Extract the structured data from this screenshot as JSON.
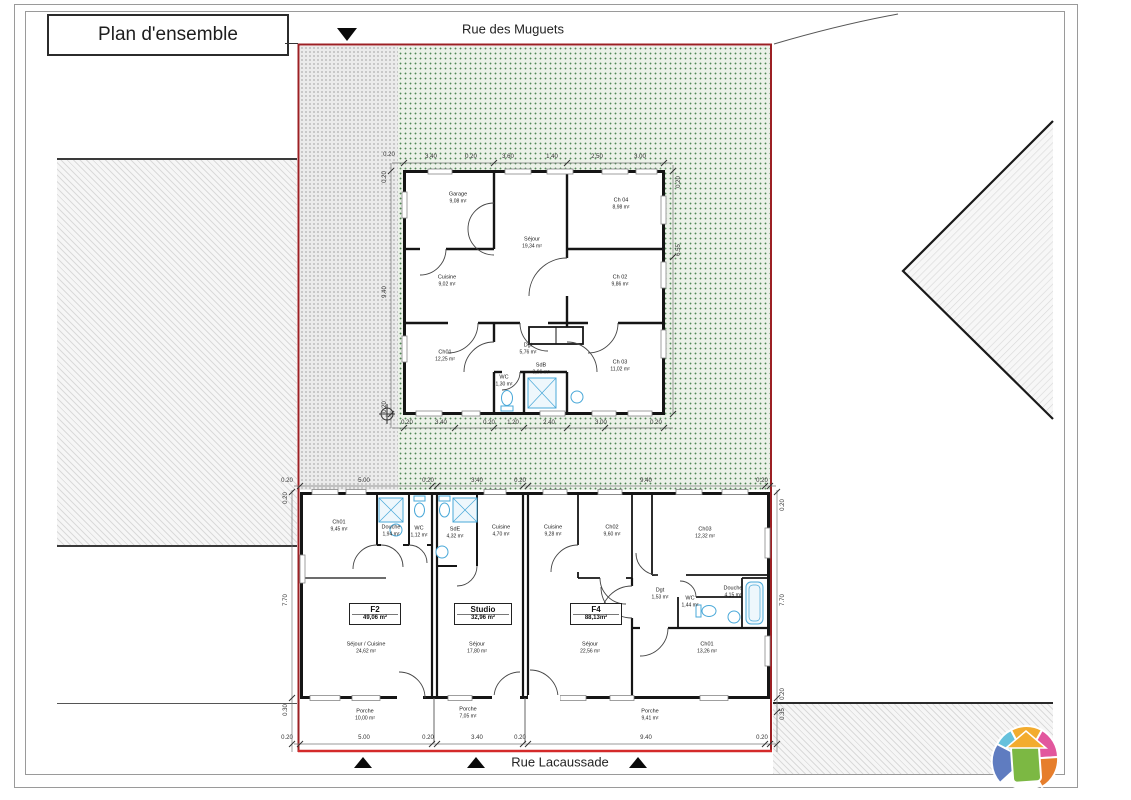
{
  "title": "Plan d'ensemble",
  "streets": {
    "top": "Rue des Muguets",
    "bottom": "Rue Lacaussade"
  },
  "house": {
    "rooms": [
      {
        "name": "Garage",
        "area": "9,08 m²"
      },
      {
        "name": "Cuisine",
        "area": "9,02 m²"
      },
      {
        "name": "Séjour",
        "area": "19,34 m²"
      },
      {
        "name": "Ch 04",
        "area": "8,98 m²"
      },
      {
        "name": "Ch 02",
        "area": "9,86 m²"
      },
      {
        "name": "Ch01",
        "area": "12,25 m²"
      },
      {
        "name": "Dgt",
        "area": "5,76 m²"
      },
      {
        "name": "Ch 03",
        "area": "11,02 m²"
      },
      {
        "name": "WC",
        "area": "1,30 m²"
      },
      {
        "name": "SdB",
        "area": "3,96 m²"
      }
    ]
  },
  "units": {
    "f2": {
      "label": "F2",
      "area": "49,06 m²",
      "rooms": [
        {
          "name": "Ch01",
          "area": "9,45 m²"
        },
        {
          "name": "Douche",
          "area": "1,94 m²"
        },
        {
          "name": "WC",
          "area": "1,12 m²"
        },
        {
          "name": "Séjour / Cuisine",
          "area": "24,62 m²"
        }
      ]
    },
    "studio": {
      "label": "Studio",
      "area": "32,96 m²",
      "rooms": [
        {
          "name": "SdE",
          "area": "4,32 m²"
        },
        {
          "name": "Cuisine",
          "area": "4,70 m²"
        },
        {
          "name": "Séjour",
          "area": "17,80 m²"
        }
      ]
    },
    "f4": {
      "label": "F4",
      "area": "88,13m²",
      "rooms": [
        {
          "name": "Cuisine",
          "area": "9,28 m²"
        },
        {
          "name": "Ch02",
          "area": "9,60 m²"
        },
        {
          "name": "Ch03",
          "area": "12,32 m²"
        },
        {
          "name": "Dgt",
          "area": "1,53 m²"
        },
        {
          "name": "WC",
          "area": "1,44 m²"
        },
        {
          "name": "Douche",
          "area": "4,15 m²"
        },
        {
          "name": "Séjour",
          "area": "22,56 m²"
        },
        {
          "name": "Ch01",
          "area": "13,26 m²"
        }
      ]
    }
  },
  "porches": [
    {
      "name": "Porche",
      "area": "10,00 m²"
    },
    {
      "name": "Porche",
      "area": "7,05 m²"
    },
    {
      "name": "Porche",
      "area": "9,41 m²"
    }
  ],
  "dims": {
    "building_top": [
      "0.20",
      "5.00",
      "0.20",
      "3.40",
      "0.20",
      "9.40",
      "0.20"
    ],
    "building_bottom": [
      "0.20",
      "5.00",
      "0.20",
      "3.40",
      "0.20",
      "9.40",
      "0.20"
    ],
    "building_left": [
      "0.20",
      "7.70",
      "0.30"
    ],
    "building_right": [
      "0.20",
      "7.70",
      "0.20",
      "0.35"
    ],
    "house_top": [
      "0.20",
      "3.40",
      "0.20",
      "3.60",
      "1.40",
      "2.50",
      "3.00"
    ],
    "house_bottom": [
      "0.20",
      "3.40",
      "0.20",
      "1.20",
      "2.40",
      "3.00",
      "0.20"
    ],
    "house_left": [
      "0.20",
      "9.40",
      "0.20"
    ],
    "house_right": [
      "0.20",
      "6.55"
    ]
  },
  "colors": {
    "boundary": "#9c2024",
    "boundary_bright": "#d42a2a",
    "wall": "#151515",
    "fixture": "#49a8d8",
    "green_dot": "#2a6c30"
  }
}
